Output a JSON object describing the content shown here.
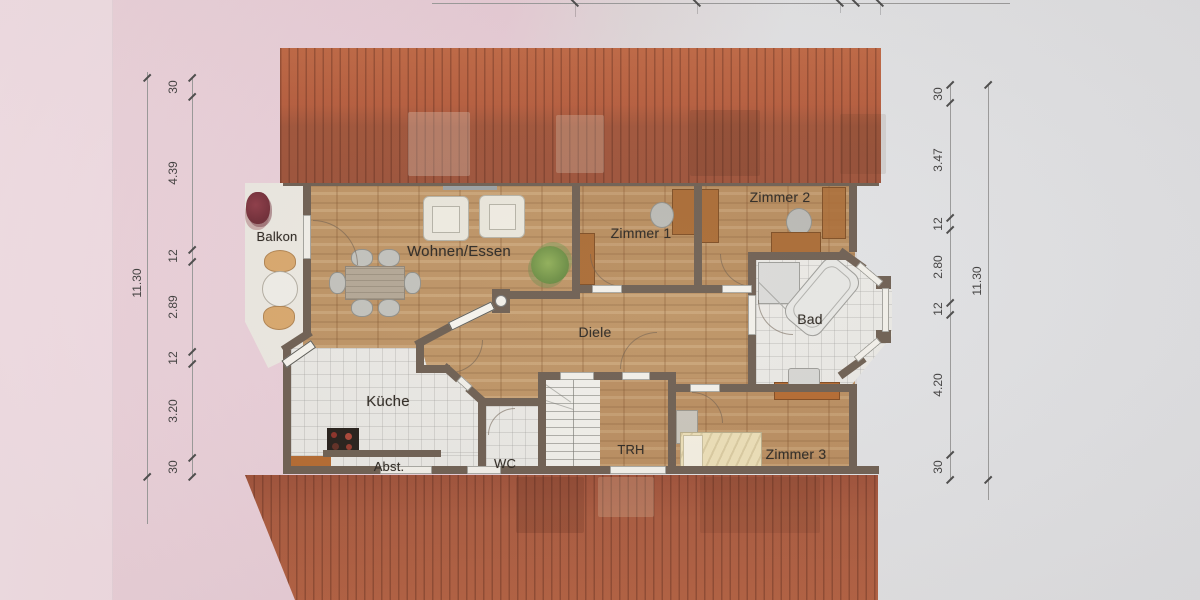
{
  "document": {
    "type": "floor-plan"
  },
  "rooms": {
    "balkon": "Balkon",
    "wohnen_essen": "Wohnen/Essen",
    "zimmer1": "Zimmer 1",
    "zimmer2": "Zimmer 2",
    "diele": "Diele",
    "bad": "Bad",
    "kueche": "Küche",
    "abst": "Abst.",
    "wc": "WC",
    "trh": "TRH",
    "zimmer3": "Zimmer 3"
  },
  "dimensions": {
    "left": {
      "overall": "11.30",
      "chain": [
        "30",
        "4.39",
        "12",
        "2.89",
        "12",
        "3.20",
        "30"
      ]
    },
    "right": {
      "overall": "11.30",
      "chain": [
        "30",
        "3.47",
        "12",
        "2.80",
        "12",
        "4.20",
        "30"
      ]
    }
  },
  "colors": {
    "roof": "#b35b3d",
    "wall": "#6d5e51",
    "wood_floor": "#bd9364",
    "tile_floor": "#eae9e5",
    "background_left": "#e9cfd9",
    "background_right": "#e1e2e4"
  }
}
